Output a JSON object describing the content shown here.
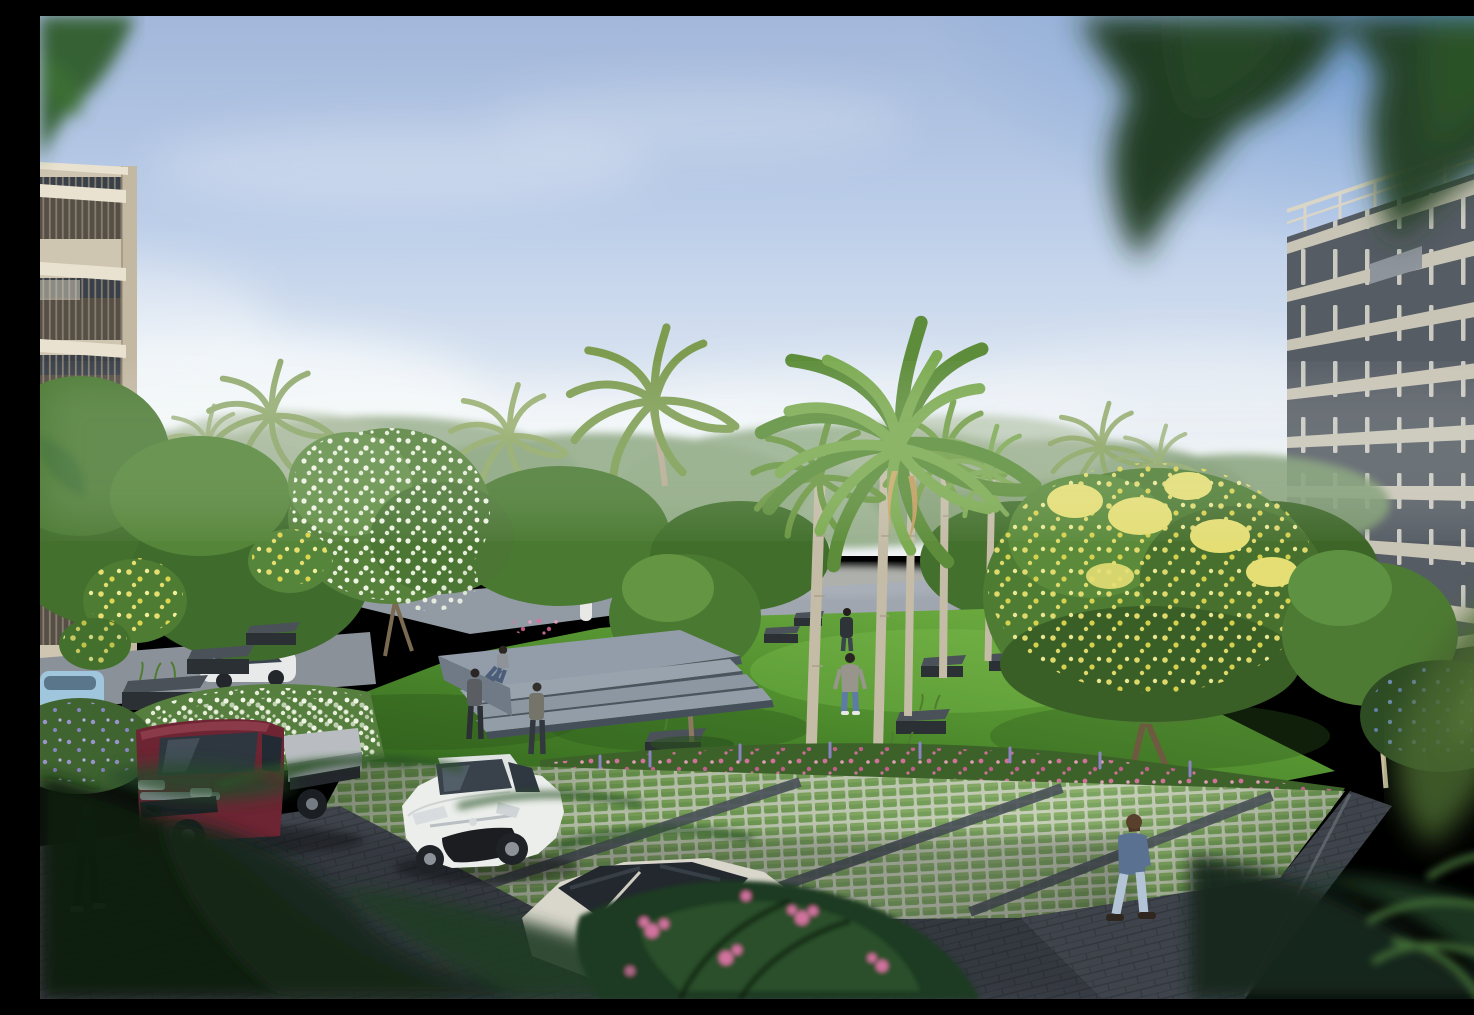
{
  "meta": {
    "type": "architectural-render",
    "description": "Sunlit landscaped courtyard park between two apartment blocks: central lawn with royal palms and planter boxes, stepped concrete plaza, grass-grid paver parking with a white sedan and a maroon flatbed truck, people strolling, lush flowering trees, blurred foreground leaves framing the view",
    "width_px": 1474,
    "height_px": 983
  },
  "palette": {
    "sky_top": "#a2b7da",
    "sky_mid": "#bccee9",
    "sky_low": "#e2eaf3",
    "sky_horizon": "#f1f4f6",
    "sky_corner_blue": "#4f87c8",
    "cloud_white": "#f7fafc",
    "treeline_haze": "#9cb18f",
    "canopy_dark": "#2e5523",
    "canopy_mid": "#4b7d33",
    "canopy_light": "#639543",
    "canopy_highlight": "#8cc45c",
    "palm_frond": "#6f9a44",
    "trunk_pale": "#c4bca6",
    "trunk_brown": "#7a6a52",
    "flower_white": "#eef3e3",
    "flower_yellow": "#e6df6f",
    "flower_pink": "#d8729f",
    "flower_lavender": "#9a94cf",
    "flower_blue": "#7f9cd4",
    "lawn_light": "#79b748",
    "lawn_mid": "#4c8a2c",
    "lawn_dark": "#2f5f1b",
    "plaza_top": "#939da9",
    "plaza_riser": "#4b5560",
    "planter_dark": "#2b3034",
    "paver_base": "#c2cbb4",
    "paver_grass": "#6d9a50",
    "path_dark": "#3f444c",
    "road_grey": "#8b9198",
    "left_wall": "#cfc6b2",
    "left_band": "#e9e2d0",
    "left_balcony": "#554f45",
    "right_facade": "#565c64",
    "right_band": "#c9c5b6",
    "right_pillar": "#b5b2a6",
    "right_glass": "#36404c",
    "truck_maroon": "#6d2433",
    "truck_bed": "#b9bdc1",
    "car_white": "#eceeec",
    "car_glass": "#39414b",
    "hatch_roof": "#23282e",
    "skin": "#caa88a",
    "denim": "#5b7192",
    "jeans_light": "#b3c4d6"
  },
  "scene": {
    "setting": "Residential courtyard park, bright daytime, hazy blue sky with low clouds",
    "buildings": [
      {
        "id": "left-building",
        "style": "beige apartment block with louvered balcony railings",
        "position": "left edge"
      },
      {
        "id": "right-building",
        "style": "dark grey block, cream floor bands, narrow vertical window slits, rooftop railing",
        "position": "right edge"
      }
    ],
    "vegetation": [
      "tall coconut palm on skyline",
      "foxtail palm crown over central lawn",
      "cluster of slender royal palm trunks",
      "white flowering tree",
      "large yellow flowering tree",
      "white flower hedge",
      "pink flower hedge",
      "lavender shrubs",
      "blue flower shrubs",
      "blurred out-of-focus leaves framing top corners and bottom"
    ],
    "people": [
      {
        "id": "man-walking-towards",
        "clothing": "grey sweatshirt, blue jeans",
        "location": "central lawn"
      },
      {
        "id": "man-walking-away",
        "clothing": "dark jacket",
        "location": "upper lawn"
      },
      {
        "id": "person-sitting-on-steps",
        "location": "plaza platform edge"
      },
      {
        "id": "person-standing-a",
        "location": "grass below steps"
      },
      {
        "id": "person-standing-b",
        "location": "grass below steps"
      },
      {
        "id": "man-walking-right-path",
        "clothing": "denim shirt, light jeans",
        "location": "right walkway"
      },
      {
        "id": "person-in-shade",
        "location": "bottom-left walkway"
      }
    ],
    "vehicles": [
      {
        "id": "flatbed-truck",
        "color": "maroon cab, silver bed",
        "location": "left parking bay"
      },
      {
        "id": "white-sedan",
        "color": "white",
        "location": "centre parking bay"
      },
      {
        "id": "hatchback",
        "color": "cream body, dark roof",
        "location": "foreground behind shrubs"
      },
      {
        "id": "distant-white-sedan",
        "location": "far-left road"
      },
      {
        "id": "distant-blue-car",
        "location": "far-left road"
      }
    ],
    "hardscape": [
      "stepped concrete plaza with three treads",
      "grass-grid paver parking lot with dark expansion strips",
      "dark paver walkways front and right",
      "dark rectangular planter boxes dotted on lawn"
    ]
  }
}
